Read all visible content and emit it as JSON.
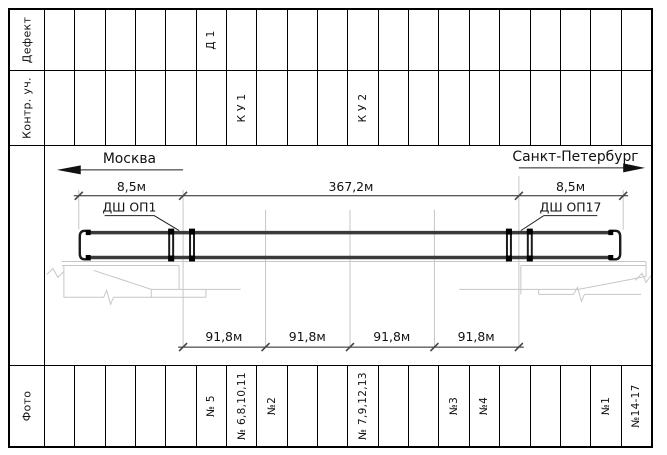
{
  "colors": {
    "line": "#000000",
    "deck": "#3a3a3a",
    "light_line": "#c6c6c6"
  },
  "bands": {
    "defect": {
      "label": "Дефект",
      "cells": [
        "",
        "",
        "",
        "",
        "",
        "Д 1",
        "",
        "",
        "",
        "",
        "",
        "",
        "",
        "",
        "",
        "",
        "",
        "",
        "",
        ""
      ]
    },
    "control": {
      "label": "Контр. уч.",
      "cells": [
        "",
        "",
        "",
        "",
        "",
        "",
        "К У 1",
        "",
        "",
        "",
        "К У 2",
        "",
        "",
        "",
        "",
        "",
        "",
        "",
        "",
        ""
      ]
    },
    "photo": {
      "label": "Фото",
      "cells": [
        "",
        "",
        "",
        "",
        "",
        "№ 5",
        "№ 6,8,10,11",
        "№2",
        "",
        "",
        "№ 7,9,12,13",
        "",
        "",
        "№3",
        "№4",
        "",
        "",
        "",
        "№1",
        "№14-17"
      ]
    }
  },
  "drawing": {
    "direction_left": "Москва",
    "direction_right": "Санкт-Петербург",
    "dim_left": "8,5м",
    "dim_main": "367,2м",
    "dim_right": "8,5м",
    "joint_left": "ДШ ОП1",
    "joint_right": "ДШ ОП17",
    "span_dims": [
      "91,8м",
      "91,8м",
      "91,8м",
      "91,8м"
    ]
  }
}
